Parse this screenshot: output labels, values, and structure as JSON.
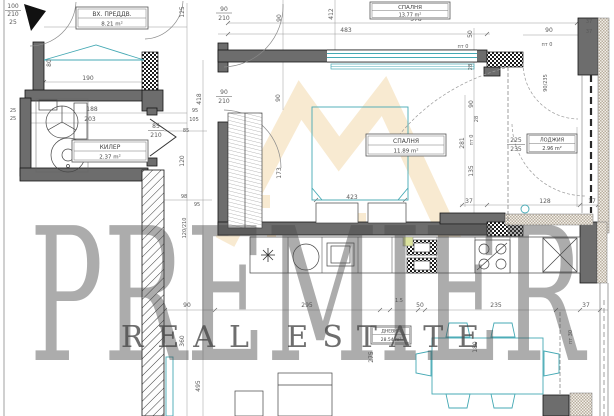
{
  "watermark": {
    "brand": "PREMIER",
    "tagline": "REAL ESTATE"
  },
  "rooms": {
    "entry": {
      "name": "ВХ. ПРЕДДВ.",
      "area": "8.21 m²"
    },
    "bedroom_top": {
      "name": "СПАЛНЯ",
      "area": "13.77 m²"
    },
    "closet": {
      "name": "КИЛЕР",
      "area": "2.37 m²"
    },
    "bedroom": {
      "name": "СПАЛНЯ",
      "area": "11.89 m²"
    },
    "loggia": {
      "name": "ЛОДЖИЯ",
      "area": "2.96 m²"
    },
    "living": {
      "name": "ДНЕВНА",
      "area": "28.54 m²"
    }
  },
  "dims": {
    "d100": "100",
    "d210_entry": "210",
    "d25_tl": "25",
    "d320": "320",
    "d190": "190",
    "d80": "80",
    "d125": "125",
    "d90_210_top_n": "90",
    "d90_210_top_d": "210",
    "d90_top_rot": "90",
    "d412": "412",
    "d578": "578",
    "d483": "483",
    "d50_rot": "50",
    "d90_door_tr": "90",
    "d37_a": "37",
    "d37_b": "37",
    "pt0_a": "пт 0",
    "pt0_b": "пт 0",
    "pt0_c": "пт 0",
    "pt30": "пт 30",
    "d28_a": "28",
    "d28_b": "28",
    "d90_210_bed_n": "90",
    "d90_210_bed_d": "210",
    "d90_bed_rot": "90",
    "d418": "418",
    "d95_a": "95",
    "d105": "105",
    "d85_n": "85",
    "d85_d": "210",
    "d85_side": "85",
    "d188": "188",
    "d203": "203",
    "d25_a": "25",
    "d25_b": "25",
    "d120_rot": "120",
    "d173": "173",
    "d98": "98",
    "d95_b": "95",
    "d12_210": "120/210",
    "d423": "423",
    "d90_corr": "90",
    "d295": "295",
    "d15": "1.5",
    "d50_b": "50",
    "d235_b": "235",
    "d37_c": "37",
    "d360": "360",
    "d495": "495",
    "d275": "275",
    "d281": "281",
    "d90_log": "90",
    "d135": "135",
    "d231": "231",
    "d225_n": "225",
    "d225_d": "235",
    "d37_d": "37",
    "d128": "128",
    "d17": "17",
    "d90_235": "90/235",
    "d180": "180"
  }
}
